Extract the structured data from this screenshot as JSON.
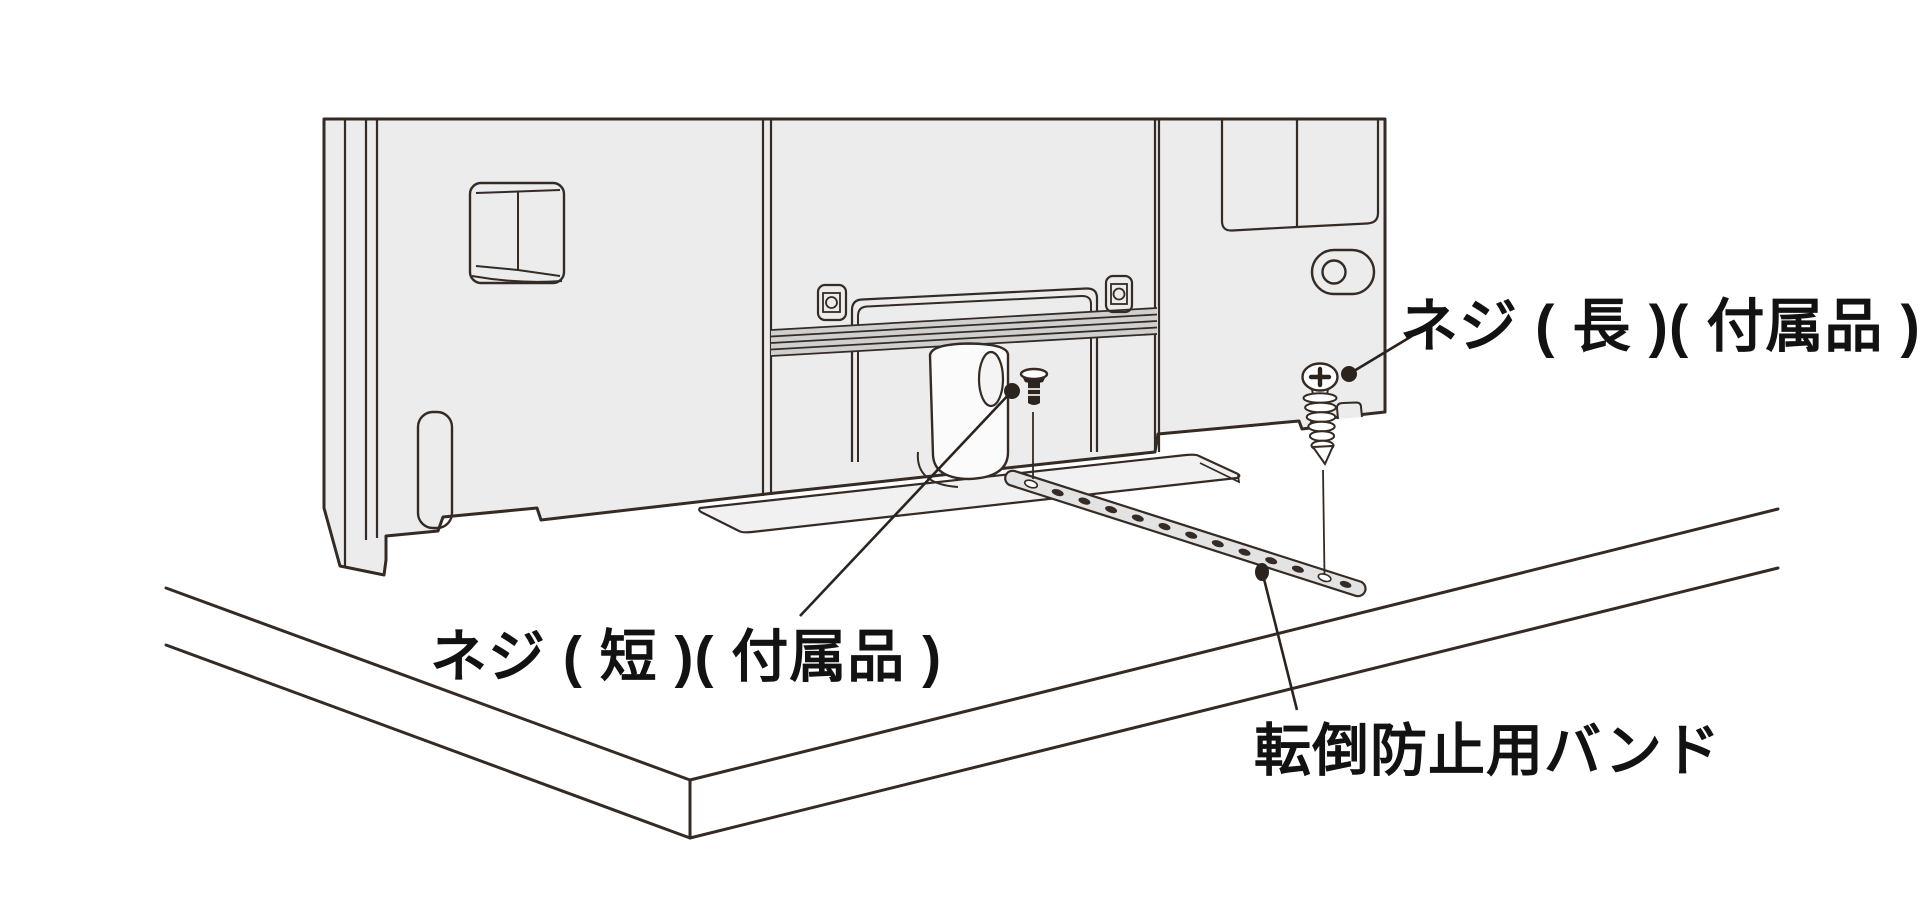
{
  "diagram": {
    "type": "tv-anti-tip-band-installation-illustration",
    "labels": {
      "screw_short": "ネジ ( 短 )( 付属品 )",
      "screw_long": "ネジ ( 長 )( 付属品 )",
      "anti_tip_band": "転倒防止用バンド"
    },
    "colors": {
      "line": "#352b24",
      "panel_fill": "#ececec",
      "stripe_fill": "#cfcfcf",
      "band_fill": "#e3e3e3",
      "plate_fill": "#f1f1f1",
      "text": "#121212",
      "background": "#ffffff"
    }
  }
}
